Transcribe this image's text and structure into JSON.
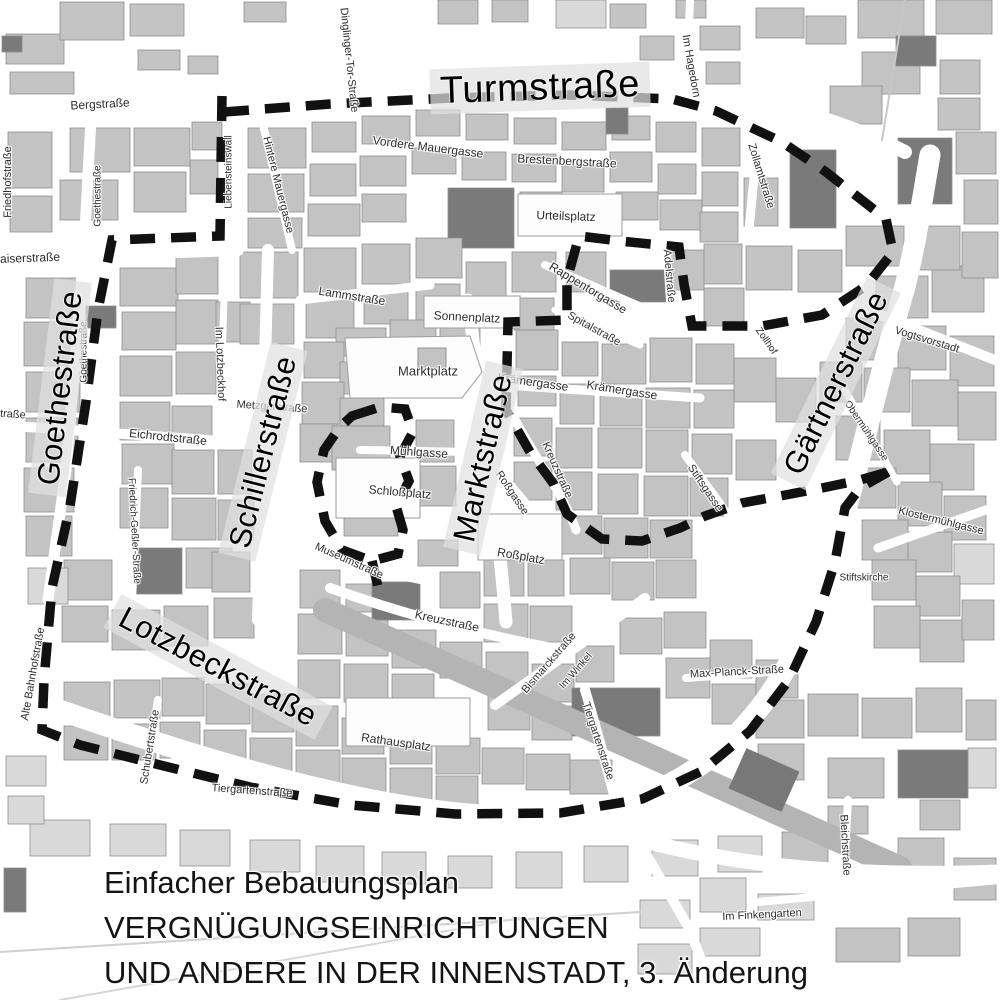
{
  "map": {
    "caption": {
      "line1": "Einfacher Bebauungsplan",
      "line2": "VERGNÜGUNGSEINRICHTUNGEN",
      "line3": "UND ANDERE IN DER INNENSTADT, 3. Änderung"
    },
    "colors": {
      "background": "#ffffff",
      "building": "#c3c3c3",
      "building_dark": "#7a7a7a",
      "building_light": "#d9d9d9",
      "building_stroke": "#8f8f8f",
      "boundary_dash": "#111111",
      "label_text": "#2e2e2e",
      "band": "#e1e1e1"
    },
    "major_labels": [
      {
        "text": "Turmstraße",
        "x": 540,
        "y": 88,
        "rot": -2,
        "size": 38
      },
      {
        "text": "Goethestraße",
        "x": 60,
        "y": 388,
        "rot": -83,
        "size": 31
      },
      {
        "text": "Schillerstraße",
        "x": 263,
        "y": 452,
        "rot": -76,
        "size": 31
      },
      {
        "text": "Marktstraße",
        "x": 483,
        "y": 458,
        "rot": -77,
        "size": 31
      },
      {
        "text": "Gärtnerstraße",
        "x": 836,
        "y": 383,
        "rot": -64,
        "size": 31
      },
      {
        "text": "Lotzbeckstraße",
        "x": 218,
        "y": 667,
        "rot": 28,
        "size": 31
      }
    ],
    "street_labels": [
      {
        "text": "Bergstraße",
        "x": 100,
        "y": 104,
        "rot": -3,
        "size": 12
      },
      {
        "text": "Friedhofstraße",
        "x": 8,
        "y": 182,
        "rot": -90,
        "size": 11
      },
      {
        "text": "Goethestraße",
        "x": 98,
        "y": 196,
        "rot": -90,
        "size": 10
      },
      {
        "text": "Goethestraße",
        "x": 84,
        "y": 352,
        "rot": -90,
        "size": 10
      },
      {
        "text": "Kaiserstraße",
        "x": 26,
        "y": 258,
        "rot": -2,
        "size": 12
      },
      {
        "text": "Dinglinger-Tor-Straße",
        "x": 349,
        "y": 60,
        "rot": 84,
        "size": 11
      },
      {
        "text": "Vordere Mauergasse",
        "x": 428,
        "y": 147,
        "rot": 7,
        "size": 12
      },
      {
        "text": "Hintere Mauergasse",
        "x": 278,
        "y": 185,
        "rot": 76,
        "size": 11
      },
      {
        "text": "Liebensteinswall",
        "x": 229,
        "y": 172,
        "rot": -90,
        "size": 10
      },
      {
        "text": "Brestenbergstraße",
        "x": 567,
        "y": 161,
        "rot": 3,
        "size": 12
      },
      {
        "text": "Urteilsplatz",
        "x": 566,
        "y": 216,
        "rot": 2,
        "size": 12
      },
      {
        "text": "Im Hagedorn",
        "x": 691,
        "y": 66,
        "rot": 80,
        "size": 11
      },
      {
        "text": "Zollamtstraße",
        "x": 761,
        "y": 176,
        "rot": 73,
        "size": 11
      },
      {
        "text": "Zollhof",
        "x": 766,
        "y": 341,
        "rot": 55,
        "size": 10
      },
      {
        "text": "Lammstraße",
        "x": 352,
        "y": 296,
        "rot": 9,
        "size": 12
      },
      {
        "text": "Sonnenplatz",
        "x": 467,
        "y": 317,
        "rot": 3,
        "size": 12
      },
      {
        "text": "Marktplatz",
        "x": 428,
        "y": 371,
        "rot": 0,
        "size": 13
      },
      {
        "text": "Rappentorgasse",
        "x": 588,
        "y": 288,
        "rot": 31,
        "size": 12
      },
      {
        "text": "Spitalstraße",
        "x": 594,
        "y": 329,
        "rot": 29,
        "size": 11
      },
      {
        "text": "Adelstraße",
        "x": 669,
        "y": 276,
        "rot": 85,
        "size": 11
      },
      {
        "text": "Krämergasse",
        "x": 533,
        "y": 382,
        "rot": 8,
        "size": 12
      },
      {
        "text": "Krämergasse",
        "x": 622,
        "y": 390,
        "rot": 9,
        "size": 12
      },
      {
        "text": "Roßgasse",
        "x": 512,
        "y": 493,
        "rot": 56,
        "size": 11
      },
      {
        "text": "Roßplatz",
        "x": 521,
        "y": 556,
        "rot": 10,
        "size": 12
      },
      {
        "text": "Kreuzstraße",
        "x": 557,
        "y": 470,
        "rot": 66,
        "size": 11
      },
      {
        "text": "Stiftsgasse",
        "x": 705,
        "y": 488,
        "rot": 56,
        "size": 11
      },
      {
        "text": "Mühlgasse",
        "x": 419,
        "y": 452,
        "rot": 4,
        "size": 12
      },
      {
        "text": "Schloßplatz",
        "x": 400,
        "y": 492,
        "rot": 5,
        "size": 12
      },
      {
        "text": "Museumstraße",
        "x": 349,
        "y": 561,
        "rot": 24,
        "size": 11
      },
      {
        "text": "Metzgerstraße",
        "x": 272,
        "y": 407,
        "rot": 4,
        "size": 11
      },
      {
        "text": "Eichrodtstraße",
        "x": 168,
        "y": 437,
        "rot": 6,
        "size": 12
      },
      {
        "text": "Eichrodtstraße",
        "x": -10,
        "y": 413,
        "rot": 4,
        "size": 11
      },
      {
        "text": "Im Lotzbeckhof",
        "x": 220,
        "y": 364,
        "rot": 88,
        "size": 11
      },
      {
        "text": "Friedrich-Geßler-Straße",
        "x": 134,
        "y": 531,
        "rot": 87,
        "size": 10
      },
      {
        "text": "Alte Bahnhofstraße",
        "x": 33,
        "y": 674,
        "rot": -80,
        "size": 11
      },
      {
        "text": "Schubertstraße",
        "x": 150,
        "y": 747,
        "rot": -81,
        "size": 11
      },
      {
        "text": "Tiergartenstraße",
        "x": 252,
        "y": 791,
        "rot": 4,
        "size": 11
      },
      {
        "text": "Rathausplatz",
        "x": 396,
        "y": 742,
        "rot": 8,
        "size": 12
      },
      {
        "text": "Kreuzstraße",
        "x": 447,
        "y": 621,
        "rot": 12,
        "size": 12
      },
      {
        "text": "Bismarckstraße",
        "x": 549,
        "y": 663,
        "rot": -49,
        "size": 11
      },
      {
        "text": "Im Winkel",
        "x": 576,
        "y": 671,
        "rot": -49,
        "size": 10
      },
      {
        "text": "Tiergartenstraße",
        "x": 598,
        "y": 741,
        "rot": 72,
        "size": 11
      },
      {
        "text": "Max-Planck-Straße",
        "x": 737,
        "y": 672,
        "rot": -3,
        "size": 11
      },
      {
        "text": "Vogtsvorstadt",
        "x": 927,
        "y": 340,
        "rot": 17,
        "size": 11
      },
      {
        "text": "Obermühlgasse",
        "x": 866,
        "y": 431,
        "rot": 56,
        "size": 10
      },
      {
        "text": "Klostermühlgasse",
        "x": 941,
        "y": 521,
        "rot": 14,
        "size": 11
      },
      {
        "text": "Stiftskirche",
        "x": 864,
        "y": 578,
        "rot": 0,
        "size": 10
      },
      {
        "text": "Bleichstraße",
        "x": 845,
        "y": 845,
        "rot": 87,
        "size": 11
      },
      {
        "text": "Im Finkengarten",
        "x": 762,
        "y": 915,
        "rot": -3,
        "size": 11
      }
    ]
  }
}
